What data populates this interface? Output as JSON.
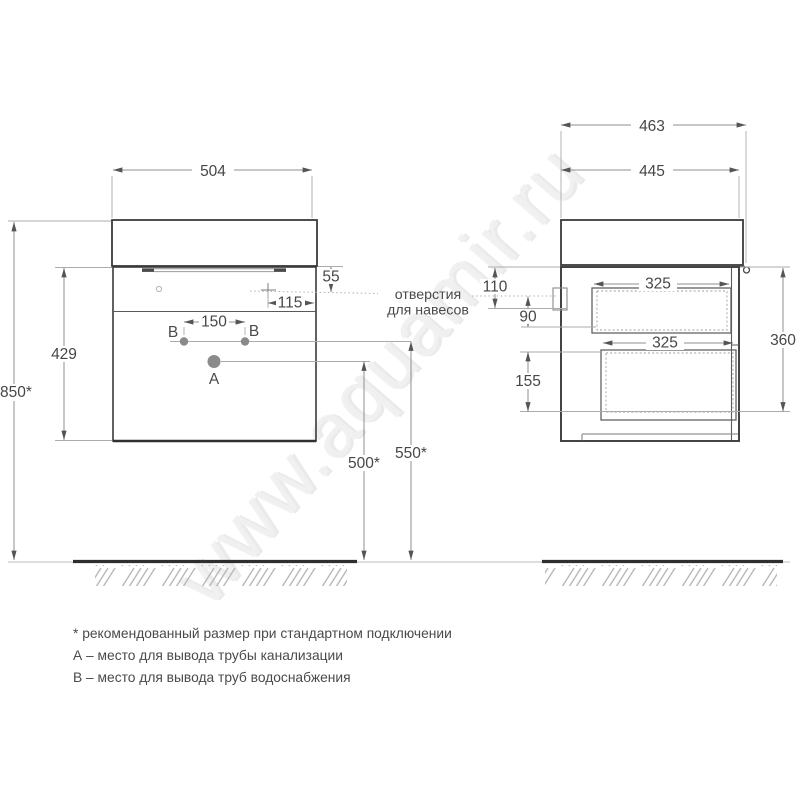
{
  "watermark": {
    "text": "www.aquamir.ru"
  },
  "front": {
    "width": "504",
    "height_overall": "850*",
    "height_carcass": "429",
    "hanger_drop": "55",
    "hanger_inset": "115",
    "holes_spacing": "150",
    "drain_height": "500*",
    "supply_height": "550*"
  },
  "side": {
    "depth_overall": "463",
    "depth_carcass": "445",
    "hanger_top_offset": "110",
    "hanger_bottom_offset": "90",
    "drawer_bottom_height": "155",
    "height": "360",
    "drawer_top_depth": "325",
    "drawer_bottom_depth": "325"
  },
  "points": {
    "a": "A",
    "b": "B"
  },
  "callout": {
    "line1": "отверстия",
    "line2": "для навесов"
  },
  "notes": [
    "* рекомендованный размер при стандартном подключении",
    "А – место для вывода трубы канализации",
    "В – место для вывода труб водоснабжения"
  ]
}
